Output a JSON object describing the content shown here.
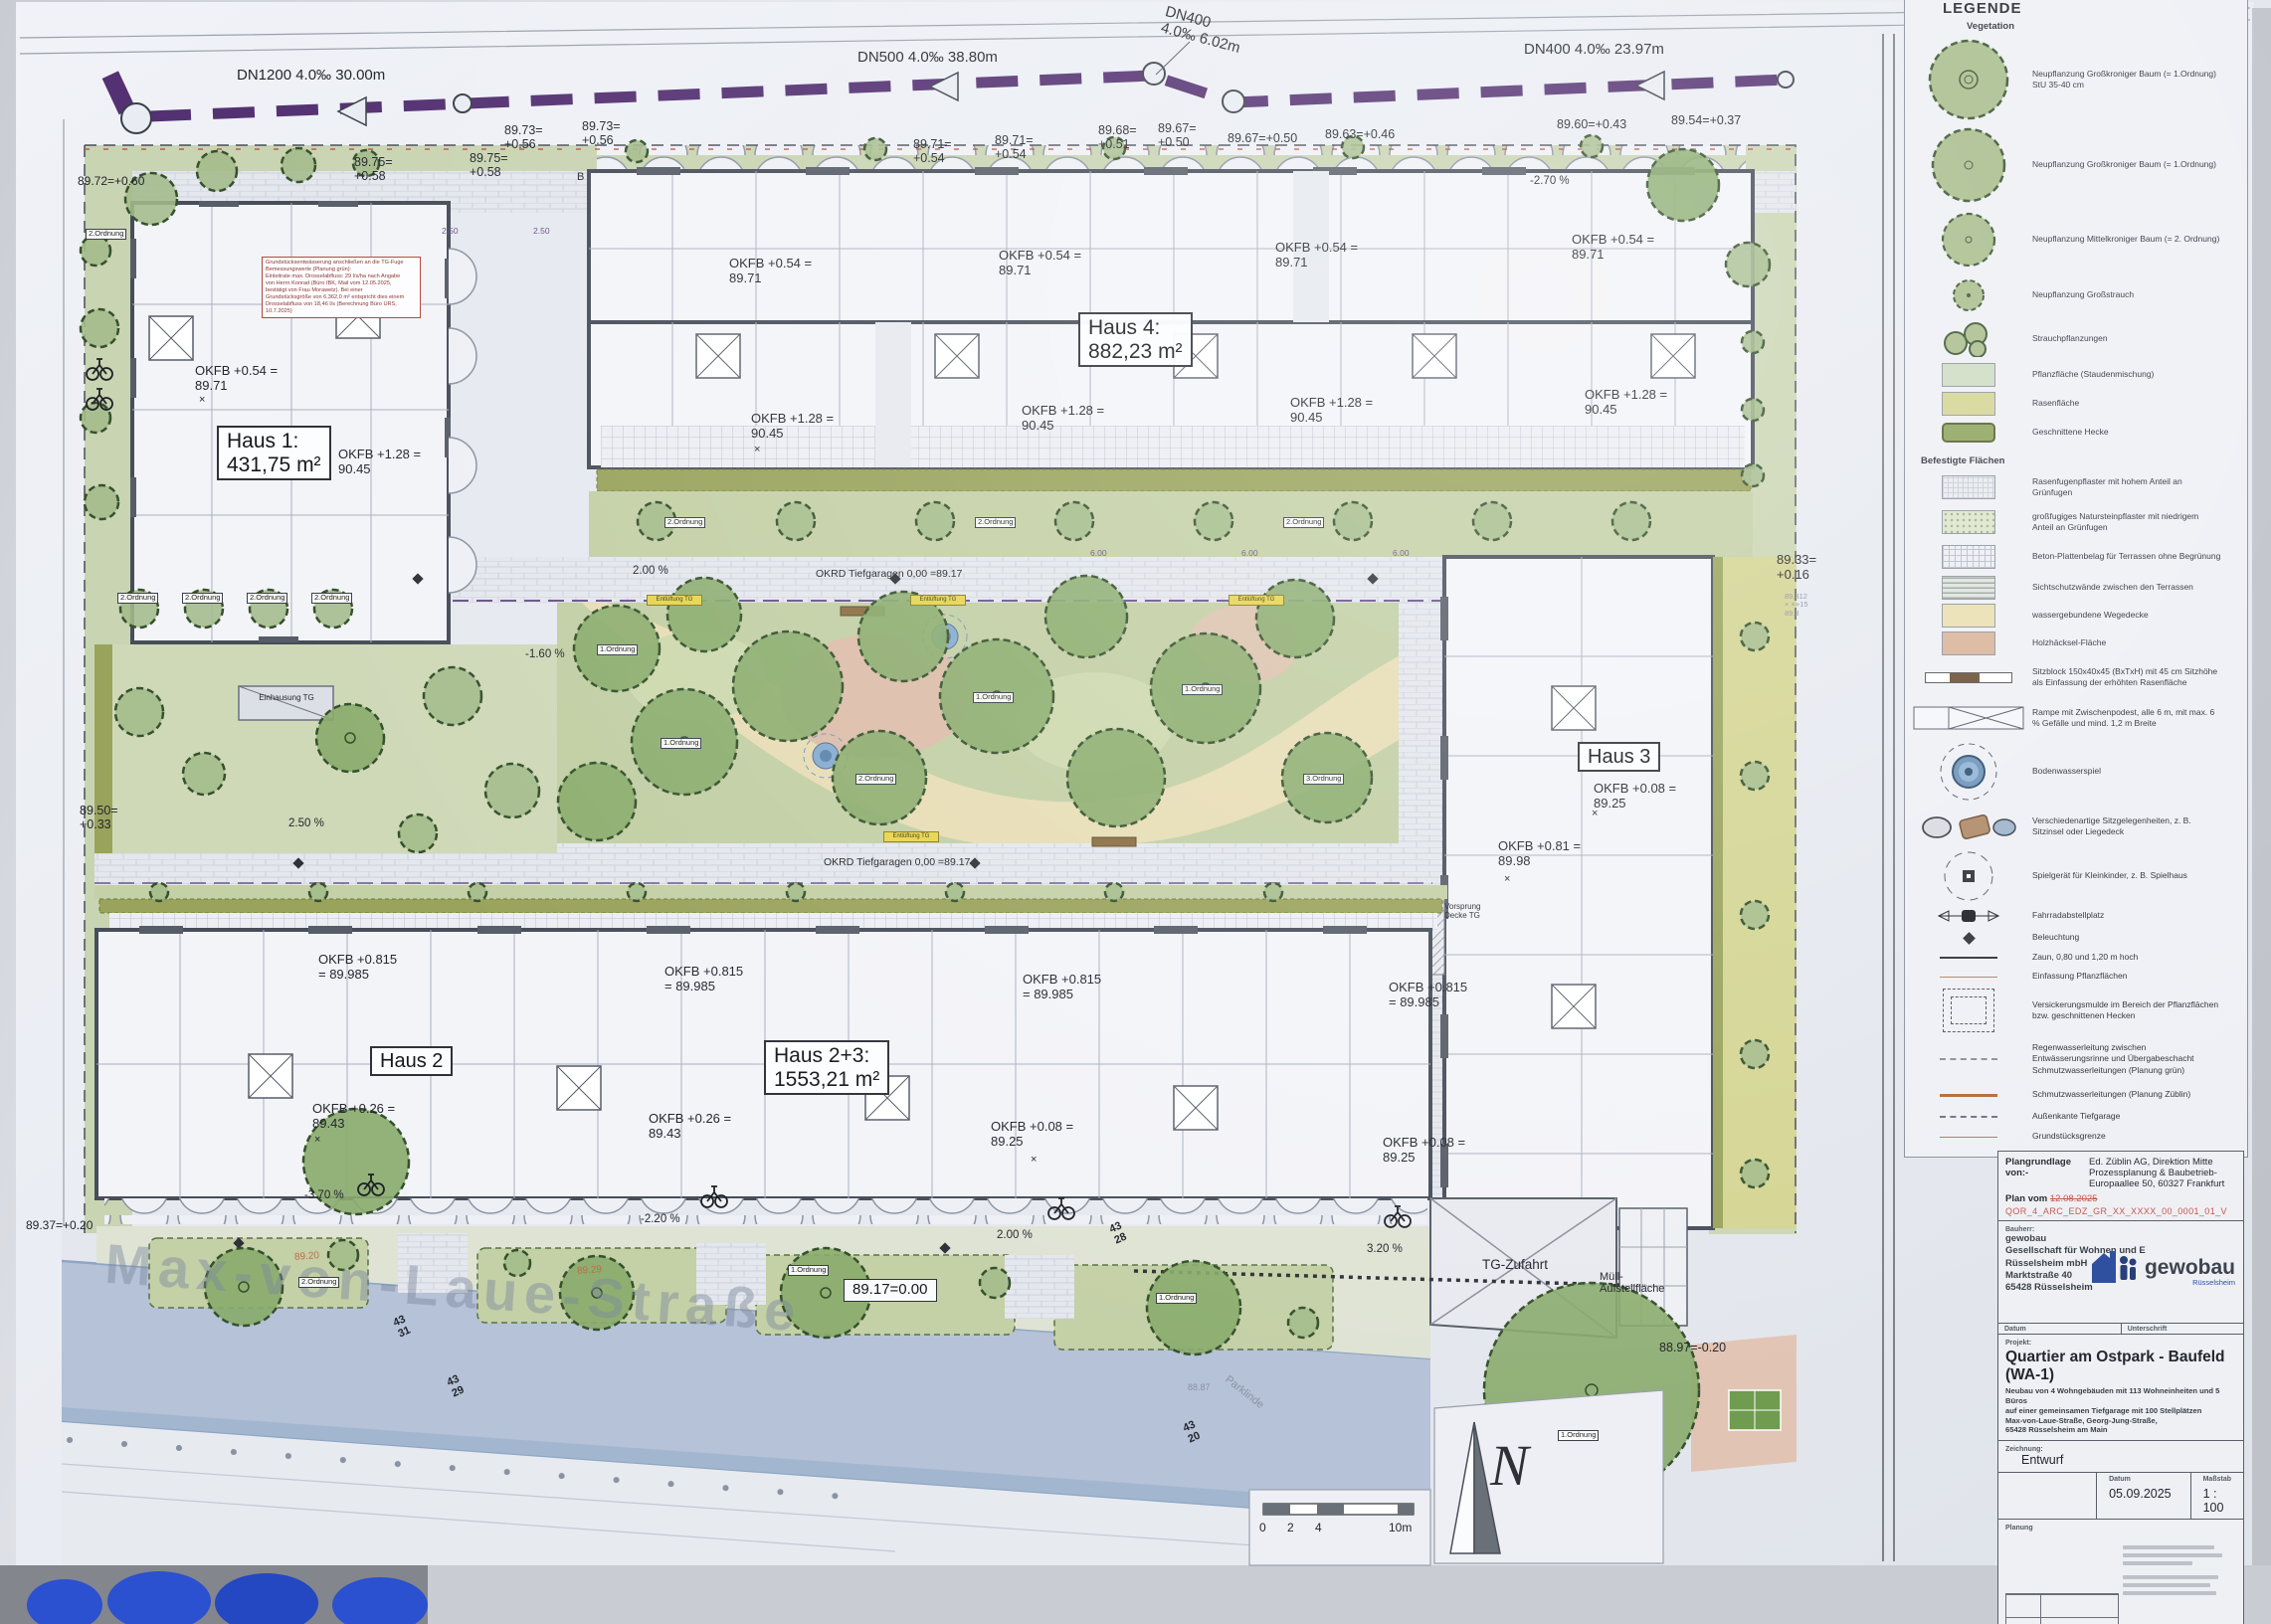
{
  "pipes": {
    "dn1200": "DN1200  4.0‰  30.00m",
    "dn500": "DN500  4.0‰  38.80m",
    "dn400a": "DN400\n4.0‰  6.02m",
    "dn400b": "DN400  4.0‰  23.97m"
  },
  "elevations": {
    "top": [
      "89.72=+0.60",
      "89.75=\n+0.58",
      "89.75=\n+0.58",
      "89.73=\n+0.56",
      "89.73=\n+0.56",
      "89.71=\n+0.54",
      "89.71=\n+0.54",
      "89.68=\n+0.51",
      "89.67=\n+0.50",
      "89.67=+0.50",
      "89.63=+0.46",
      "89.60=+0.43",
      "89.54=+0.37"
    ],
    "right": "89.33=\n+0.16",
    "right_small": "89.312\n× ×+15\n89.3",
    "left": "89.50=\n+0.33",
    "left_bottom": "89.37=+0.20",
    "bottom_right": "88.97=-0.20",
    "zero": "89.17=0.00",
    "street_pts": [
      "89.20",
      "89.29",
      "88.87"
    ]
  },
  "houses": {
    "h1": "Haus 1:\n431,75 m²",
    "h2": "Haus 2",
    "h3": "Haus 3",
    "h4": "Haus 4:\n882,23 m²",
    "h23": "Haus 2+3:\n1553,21 m²"
  },
  "okfb": [
    "OKFB +0.54 =\n89.71",
    "OKFB +0.54 =\n89.71",
    "OKFB +0.54 =\n89.71",
    "OKFB +0.54 =\n89.71",
    "OKFB +0.54 =\n89.71",
    "OKFB +1.28 =\n90.45",
    "OKFB +1.28 =\n90.45",
    "OKFB +1.28 =\n90.45",
    "OKFB +1.28 =\n90.45",
    "OKFB +1.28 =\n90.45",
    "OKFB +0.815\n= 89.985",
    "OKFB +0.815\n= 89.985",
    "OKFB +0.815\n= 89.985",
    "OKFB +0.815\n= 89.985",
    "OKFB +0.26 =\n89.43",
    "OKFB +0.26 =\n89.43",
    "OKFB +0.08 =\n89.25",
    "OKFB +0.08 =\n89.25",
    "OKFB +0.08 =\n89.25",
    "OKFB +0.81 =\n89.98"
  ],
  "slopes": [
    "-2.70 %",
    "2.50 %",
    "2.00 %",
    "-1.60 %",
    "2.00 %",
    "-3.70 %",
    "-2.20 %",
    "3.20 %"
  ],
  "dims": [
    "2.50",
    "2.50",
    "6.00",
    "6.00",
    "6.00"
  ],
  "stairs": [
    "43\n31",
    "43\n29",
    "43\n28",
    "43\n20"
  ],
  "tags": [
    "2.Ordnung",
    "2.Ordnung",
    "2.Ordnung",
    "2.Ordnung",
    "2.Ordnung",
    "1.Ordnung",
    "1.Ordnung",
    "1.Ordnung",
    "1.Ordnung",
    "2.Ordnung",
    "3.Ordnung",
    "2.Ordnung",
    "2.Ordnung",
    "2.Ordnung",
    "1.Ordnung",
    "2.Ordnung",
    "1.Ordnung",
    "1.Ordnung"
  ],
  "marks": {
    "x": "×"
  },
  "site": {
    "tg": "TG-Zufahrt",
    "muell": "Müll-\nAufstellfläche",
    "vorsprung": "Vorsprung\nDecke TG",
    "okrd": "OKRD Tiefgaragen  0,00 =89.17",
    "vent": "Entlüftung TG",
    "einhausung": "Einhausung TG",
    "street": "Max-von-Laue-Straße",
    "parklinde": "Parklinde",
    "section": "B",
    "north": "N"
  },
  "note": "Grundstücksentwässerung anschließen an die TG-Fuge\nBemessungswerte (Planung grün):\nEinleitrate max. Drosselabfluss: 29 l/s/ha nach Angabe\nvon Herrn Konrad (Büro IBK, Mail vom 12.05.2025,\nbestätigt von Frau Morawetz). Bei einer\nGrundstücksgröße von 6.362,0 m² entspricht dies einem\nDrosselabfluss von 18,46 l/s (Berechnung Büro URS, 10.7.2025)",
  "scalebar": {
    "t0": "0",
    "t1": "2",
    "t2": "4",
    "t3": "10m"
  },
  "legend": {
    "title": "LEGENDE",
    "vegetation": "Vegetation",
    "paved": "Befestigte Flächen",
    "items": [
      {
        "label": "Neupflanzung Großkroniger Baum (= 1.Ordnung) StU 35-40 cm"
      },
      {
        "label": "Neupflanzung Großkroniger Baum (= 1.Ordnung)"
      },
      {
        "label": "Neupflanzung Mittelkroniger Baum (= 2. Ordnung)"
      },
      {
        "label": "Neupflanzung Großstrauch"
      },
      {
        "label": "Strauchpflanzungen"
      },
      {
        "label": "Pflanzfläche (Staudenmischung)"
      },
      {
        "label": "Rasenfläche"
      },
      {
        "label": "Geschnittene Hecke"
      },
      {
        "label": "Rasenfugenpflaster mit hohem Anteil an Grünfugen"
      },
      {
        "label": "großfugiges Natursteinpflaster mit niedrigem Anteil an Grünfugen"
      },
      {
        "label": "Beton-Plattenbelag für Terrassen ohne Begrünung"
      },
      {
        "label": "Sichtschutzwände zwischen den Terrassen"
      },
      {
        "label": "wassergebundene Wegedecke"
      },
      {
        "label": "Holzhäcksel-Fläche"
      },
      {
        "label": "Sitzblock 150x40x45 (BxTxH) mit 45 cm Sitzhöhe als Einfassung der erhöhten Rasenfläche"
      },
      {
        "label": "Rampe mit Zwischenpodest, alle 6 m, mit max. 6 % Gefälle und mind. 1,2 m Breite"
      },
      {
        "label": "Bodenwasserspiel"
      },
      {
        "label": "Verschiedenartige Sitzgelegenheiten, z. B. Sitzinsel oder Liegedeck"
      },
      {
        "label": "Spielgerät für Kleinkinder, z. B. Spielhaus"
      },
      {
        "label": "Fahrradabstellplatz"
      },
      {
        "label": "Beleuchtung"
      },
      {
        "label": "Zaun, 0,80 und 1,20 m hoch"
      },
      {
        "label": "Einfassung Pflanzflächen"
      },
      {
        "label": "Versickerungsmulde im Bereich der Pflanzflächen bzw. geschnittenen Hecken"
      },
      {
        "label": "Regenwasserleitung zwischen Entwässerungsrinne und Übergabeschacht Schmutzwasserleitungen (Planung grün)"
      },
      {
        "label": "Schmutzwasserleitungen (Planung Züblin)"
      },
      {
        "label": "Außenkante Tiefgarage"
      },
      {
        "label": "Grundstücksgrenze"
      }
    ]
  },
  "titleblock": {
    "plangrundlage_label": "Plangrundlage\nvon:-",
    "plangrundlage_value": "Ed. Züblin AG, Direktion Mitte\nProzessplanung & Baubetrieb-\nEuropaallee 50, 60327 Frankfurt",
    "plan_vom_label": "Plan vom",
    "plan_vom_date": "12.08.2025",
    "plan_code": "QOR_4_ARC_EDZ_GR_XX_XXXX_00_0001_01_V",
    "bauherr_label": "Bauherr:",
    "client": "gewobau\nGesellschaft für Wohnen und E\nRüsselsheim mbH\nMarktstraße 40\n65428 Rüsselsheim",
    "logo_text": "gewobau",
    "logo_sub": "Rüsselsheim",
    "datum_label": "Datum",
    "unterschrift_label": "Unterschrift",
    "projekt_label": "Projekt:",
    "project_title": "Quartier am Ostpark - Baufeld (WA-1)",
    "project_desc": "Neubau von 4 Wohngebäuden mit 113 Wohneinheiten und 5 Büros\nauf einer gemeinsamen Tiefgarage mit 100 Stellplätzen\nMax-von-Laue-Straße, Georg-Jung-Straße,\n65428 Rüsselsheim am Main",
    "zeichnung_label": "Zeichnung:",
    "zeichnung_value": "Entwurf",
    "datum_value": "05.09.2025",
    "massstab_label": "Maßstab",
    "massstab_value": "1 : 100",
    "planung_label": "Planung",
    "gruen_logo": "grün"
  }
}
